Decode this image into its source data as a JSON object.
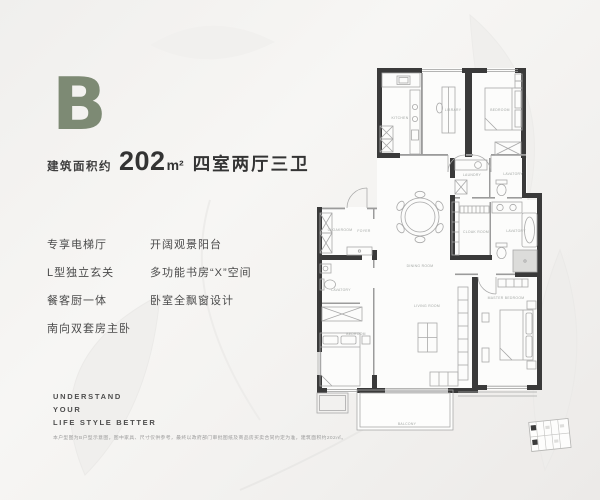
{
  "hero": {
    "letter": "B",
    "area_label": "建筑面积约",
    "area_number": "202",
    "area_unit": "m²",
    "layout_text": "四室两厅三卫",
    "accent_color": "#7d8a74"
  },
  "features": {
    "column1": [
      "专享电梯厅",
      "L型独立玄关",
      "餐客厨一体",
      "南向双套房主卧"
    ],
    "column2": [
      "开阔观景阳台",
      "多功能书房“X”空间",
      "卧室全飘窗设计"
    ]
  },
  "slogan": [
    "UNDERSTAND",
    "YOUR",
    "LIFE STYLE BETTER"
  ],
  "disclaimer": "本户型图为B户型示意图，图中家具、尺寸仅供参考，最终以政府部门审批图纸及商品房买卖合同约定为准，建筑面积约202㎡。",
  "floorplan": {
    "wall_color": "#3a3a3a",
    "line_color": "#9b9b9b",
    "label_color": "#a2a6a3",
    "labels": {
      "kitchen": "KITCHEN",
      "library": "LIBRARY",
      "bedroom_top": "BEDROOM",
      "laundry": "LAUNDRY",
      "lavatory_mid": "LAVATORY",
      "cloak_master": "CLOAK ROOM",
      "lavatory_master": "LAVATORY",
      "cloakroom": "CLOAKROOM",
      "foyer": "FOYER",
      "dining": "DINING ROOM",
      "living": "LIVING ROOM",
      "master": "MASTER BEDROOM",
      "lavatory_left": "LAVATORY",
      "bedroom_left": "BEDROOM",
      "balcony": "BALCONY"
    }
  }
}
